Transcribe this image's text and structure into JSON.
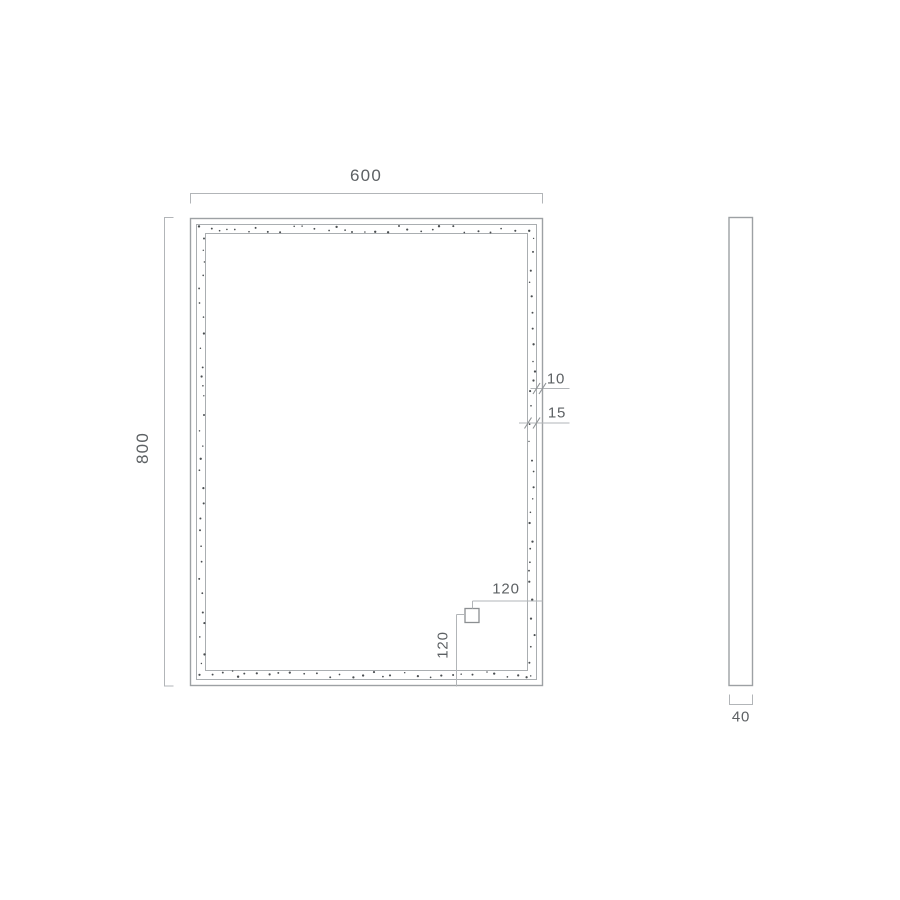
{
  "drawing": {
    "title": "mirror-dimension-drawing",
    "front_view": {
      "dims": {
        "width": "600",
        "height": "800",
        "frame_edge": "10",
        "led_band": "15",
        "sensor_from_right": "120",
        "sensor_from_bottom": "120"
      }
    },
    "side_view": {
      "dims": {
        "depth": "40"
      }
    },
    "colors": {
      "outline": "#a3a7aa",
      "dim_line": "#b2b5b8",
      "tick": "#8f9396",
      "text": "#5d6164",
      "dot": "#4a4e51",
      "background": "#ffffff"
    },
    "led_dots": {
      "pattern": "random-perimeter-band",
      "seed": 7
    }
  }
}
